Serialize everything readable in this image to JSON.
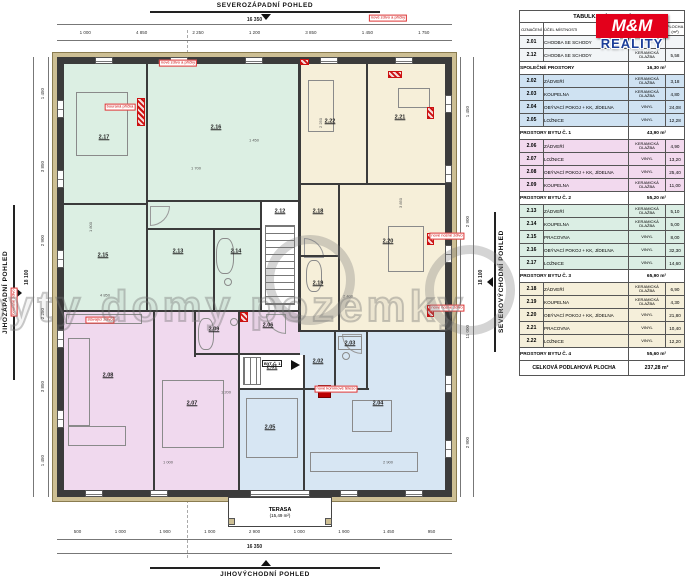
{
  "views": {
    "top": "SEVEROZÁPADNÍ POHLED",
    "bottom": "JIHOVÝCHODNÍ POHLED",
    "left": "JIHOZÁPADNÍ POHLED",
    "right": "SEVEROVÝCHODNÍ POHLED"
  },
  "logo": {
    "mm": "M&M",
    "reality": "REALITY"
  },
  "watermark": {
    "text": "byty domy pozemky"
  },
  "table": {
    "title": "TABULKA MÍSTNOSTÍ",
    "col_oznaceni": "OZNAČENÍ",
    "col_ucel": "ÚČEL MÍSTNOSTI",
    "col_povrch": "POVRCH PODLAHY",
    "col_plocha": "PLOCHA (m²)",
    "rows": [
      {
        "type": "room",
        "group": "common",
        "id": "2.01",
        "name": "CHODBA SE SCHODY",
        "floor": "",
        "area": ""
      },
      {
        "type": "room",
        "group": "common",
        "id": "2.12",
        "name": "CHODBA SE SCHODY",
        "floor": "KERAMICKÁ DLAŽBA",
        "area": "5,58"
      },
      {
        "type": "section",
        "label": "SPOLEČNÉ PROSTORY",
        "area": "16,30 m²"
      },
      {
        "type": "room",
        "group": "apt1",
        "id": "2.02",
        "name": "ZÁDVEŘÍ",
        "floor": "KERAMICKÁ DLAŽBA",
        "area": "3,18"
      },
      {
        "type": "room",
        "group": "apt1",
        "id": "2.03",
        "name": "KOUPELNA",
        "floor": "KERAMICKÁ DLAŽBA",
        "area": "4,80"
      },
      {
        "type": "room",
        "group": "apt1",
        "id": "2.04",
        "name": "OBÝVACÍ POKOJ + KK, JÍDELNA",
        "floor": "VINYL",
        "area": "24,08"
      },
      {
        "type": "room",
        "group": "apt1",
        "id": "2.05",
        "name": "LOŽNICE",
        "floor": "VINYL",
        "area": "12,28"
      },
      {
        "type": "section",
        "label": "PROSTORY BYTU Č. 1",
        "area": "43,90 m²"
      },
      {
        "type": "room",
        "group": "apt2",
        "id": "2.06",
        "name": "ZÁDVEŘÍ",
        "floor": "KERAMICKÁ DLAŽBA",
        "area": "4,90"
      },
      {
        "type": "room",
        "group": "apt2",
        "id": "2.07",
        "name": "LOŽNICE",
        "floor": "VINYL",
        "area": "13,20"
      },
      {
        "type": "room",
        "group": "apt2",
        "id": "2.08",
        "name": "OBÝVACÍ POKOJ + KK, JÍDELNA",
        "floor": "VINYL",
        "area": "25,40"
      },
      {
        "type": "room",
        "group": "apt2",
        "id": "2.09",
        "name": "KOUPELNA",
        "floor": "KERAMICKÁ DLAŽBA",
        "area": "11,00"
      },
      {
        "type": "section",
        "label": "PROSTORY BYTU Č. 2",
        "area": "55,20 m²"
      },
      {
        "type": "room",
        "group": "apt3",
        "id": "2.13",
        "name": "ZÁDVEŘÍ",
        "floor": "KERAMICKÁ DLAŽBA",
        "area": "5,10"
      },
      {
        "type": "room",
        "group": "apt3",
        "id": "2.14",
        "name": "KOUPELNA",
        "floor": "KERAMICKÁ DLAŽBA",
        "area": "5,00"
      },
      {
        "type": "room",
        "group": "apt3",
        "id": "2.15",
        "name": "PRACOVNA",
        "floor": "VINYL",
        "area": "8,00"
      },
      {
        "type": "room",
        "group": "apt3",
        "id": "2.16",
        "name": "OBÝVACÍ POKOJ + KK, JÍDELNA",
        "floor": "VINYL",
        "area": "32,30"
      },
      {
        "type": "room",
        "group": "apt3",
        "id": "2.17",
        "name": "LOŽNICE",
        "floor": "VINYL",
        "area": "14,60"
      },
      {
        "type": "section",
        "label": "PROSTORY BYTU Č. 3",
        "area": "65,90 m²"
      },
      {
        "type": "room",
        "group": "apt4",
        "id": "2.18",
        "name": "ZÁDVEŘÍ",
        "floor": "KERAMICKÁ DLAŽBA",
        "area": "6,90"
      },
      {
        "type": "room",
        "group": "apt4",
        "id": "2.19",
        "name": "KOUPELNA",
        "floor": "KERAMICKÁ DLAŽBA",
        "area": "4,30"
      },
      {
        "type": "room",
        "group": "apt4",
        "id": "2.20",
        "name": "OBÝVACÍ POKOJ + KK, JÍDELNA",
        "floor": "VINYL",
        "area": "21,80"
      },
      {
        "type": "room",
        "group": "apt4",
        "id": "2.21",
        "name": "PRACOVNA",
        "floor": "VINYL",
        "area": "10,40"
      },
      {
        "type": "room",
        "group": "apt4",
        "id": "2.22",
        "name": "LOŽNICE",
        "floor": "VINYL",
        "area": "12,20"
      },
      {
        "type": "section",
        "label": "PROSTORY BYTU Č. 4",
        "area": "55,60 m²"
      }
    ],
    "total_label": "CELKOVÁ PODLAHOVÁ PLOCHA",
    "total_value": "237,28 m²"
  },
  "plan": {
    "rooms": [
      "2.17",
      "2.16",
      "2.15",
      "2.13",
      "2.14",
      "2.12",
      "2.22",
      "2.21",
      "2.18",
      "2.19",
      "2.20",
      "2.01",
      "2.06",
      "2.09",
      "2.07",
      "2.08",
      "2.02",
      "2.03",
      "2.04",
      "2.05"
    ],
    "byt1": "BYT Č. 1",
    "terrace": {
      "line1": "TERASA",
      "line2": "(15,49 m²)"
    },
    "annotations": [
      "nové zdivo a příčky",
      "nové zdivo a příčky",
      "nové nosné zdivo",
      "nové nosné zdivo",
      "stávající zdivo",
      "nové komínové těleso",
      "bourané zdivo",
      "bouraná příčka"
    ],
    "inner_dims": [
      "1 700",
      "4 850",
      "2 400",
      "1 450",
      "3 850",
      "1 000",
      "2 900",
      "1 800",
      "2 250",
      "1 200"
    ],
    "dims": {
      "top_total": "16 350",
      "bottom_total": "16 350",
      "left_total": "18 100",
      "right_total": "18 100",
      "top_segments": [
        "1 000",
        "4 850",
        "2 250",
        "1 200",
        "3 850",
        "1 450",
        "1 750"
      ],
      "bottom_segments": [
        "500",
        "1 000",
        "1 900",
        "1 000",
        "2 900",
        "1 000",
        "1 900",
        "1 450",
        "950"
      ],
      "left_segments": [
        "1 450",
        "3 850",
        "2 900",
        "2 250",
        "3 850",
        "1 450"
      ],
      "right_segments": [
        "1 450",
        "2 900",
        "11 000",
        "2 900"
      ]
    }
  }
}
